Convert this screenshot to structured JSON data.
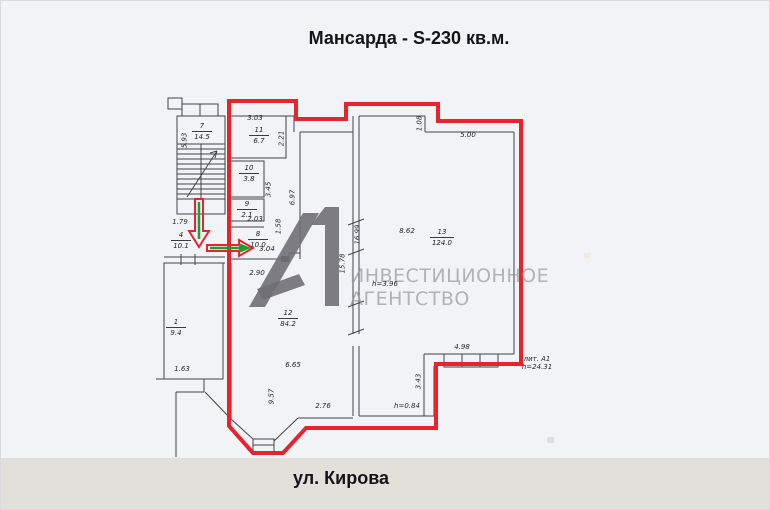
{
  "title": "Мансарда - S-230 кв.м.",
  "street": "ул. Кирова",
  "watermark": {
    "logo": "А1",
    "line1": "ИНВЕСТИЦИОННОЕ",
    "line2": "АГЕНТСТВО"
  },
  "colors": {
    "outline_red": "#e8232b",
    "arrow_green": "#239b35",
    "plan_line": "#43434b",
    "paper": "#f2f3f6",
    "street_band": "#e1e0db",
    "watermark_gray": "#9a9aa0",
    "logo_gray": "#6f6f76"
  },
  "rooms": [
    {
      "number": "7",
      "area": "14.5"
    },
    {
      "number": "11",
      "area": "6.7"
    },
    {
      "number": "10",
      "area": "3.8"
    },
    {
      "number": "9",
      "area": "2.1"
    },
    {
      "number": "8",
      "area": "10.0"
    },
    {
      "number": "4",
      "area": "10.1"
    },
    {
      "number": "1",
      "area": "9.4"
    },
    {
      "number": "12",
      "area": "84.2"
    },
    {
      "number": "13",
      "area": "124.0"
    }
  ],
  "dims": {
    "d303": "3.03",
    "d221": "2.21",
    "d593": "5.93",
    "d345": "3.45",
    "d203": "2.03",
    "d179": "1.79",
    "d158": "1.58",
    "d697": "6.97",
    "d304": "3.04",
    "d290": "2.90",
    "d163": "1.63",
    "d665": "6.65",
    "d957": "9.57",
    "d276": "2.76",
    "d1578": "15.78",
    "d1699": "16.99",
    "d862": "8.62",
    "d108": "1.08",
    "d500": "5.00",
    "d498": "4.98",
    "d343": "3.43",
    "h084": "h=0.84",
    "h396": "h=3.96",
    "lit": "лит. А1",
    "h2431": "h=24.31"
  }
}
